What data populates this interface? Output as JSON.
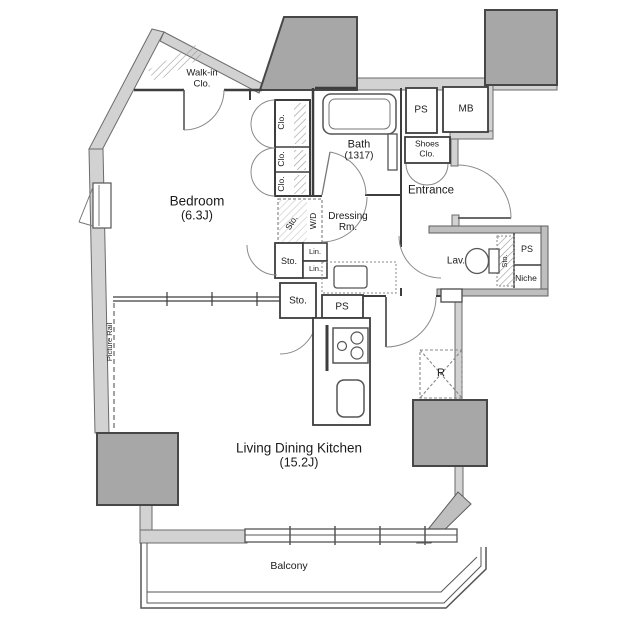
{
  "colors": {
    "wall_band": "#d2d2d2",
    "thick_wall": "#bfbfbf",
    "pillar": "#a7a7a7",
    "thin_wall": "#3d3d3d",
    "arc": "#8a8a8a",
    "text": "#1b1b1b"
  },
  "rooms": {
    "walkin": {
      "line1": "Walk-in",
      "line2": "Clo."
    },
    "bedroom": {
      "name": "Bedroom",
      "size": "(6.3J)"
    },
    "bath": {
      "name": "Bath",
      "size": "(1317)"
    },
    "entrance": {
      "name": "Entrance"
    },
    "dressing": {
      "line1": "Dressing",
      "line2": "Rm."
    },
    "lavatory": {
      "name": "Lav."
    },
    "ldk": {
      "name": "Living Dining Kitchen",
      "size": "(15.2J)"
    },
    "balcony": {
      "name": "Balcony"
    }
  },
  "fixtures": {
    "ps_shaft": "PS",
    "mail_box": "MB",
    "shoes": {
      "line1": "Shoes",
      "line2": "Clo."
    },
    "closet1": "Clo.",
    "closet2": "Clo.",
    "closet3": "Clo.",
    "storage_wd": "Sto.",
    "washer_dryer": "W/D",
    "storage_bedroom": "Sto.",
    "linen1": "Lin.",
    "linen2": "Lin.",
    "storage_hall": "Sto.",
    "ps_kitchen": "PS",
    "storage_lav": "Sto.",
    "ps_lav": "PS",
    "niche": "Niche",
    "refrigerator": "R",
    "picture_rail": "Picture Rail"
  }
}
